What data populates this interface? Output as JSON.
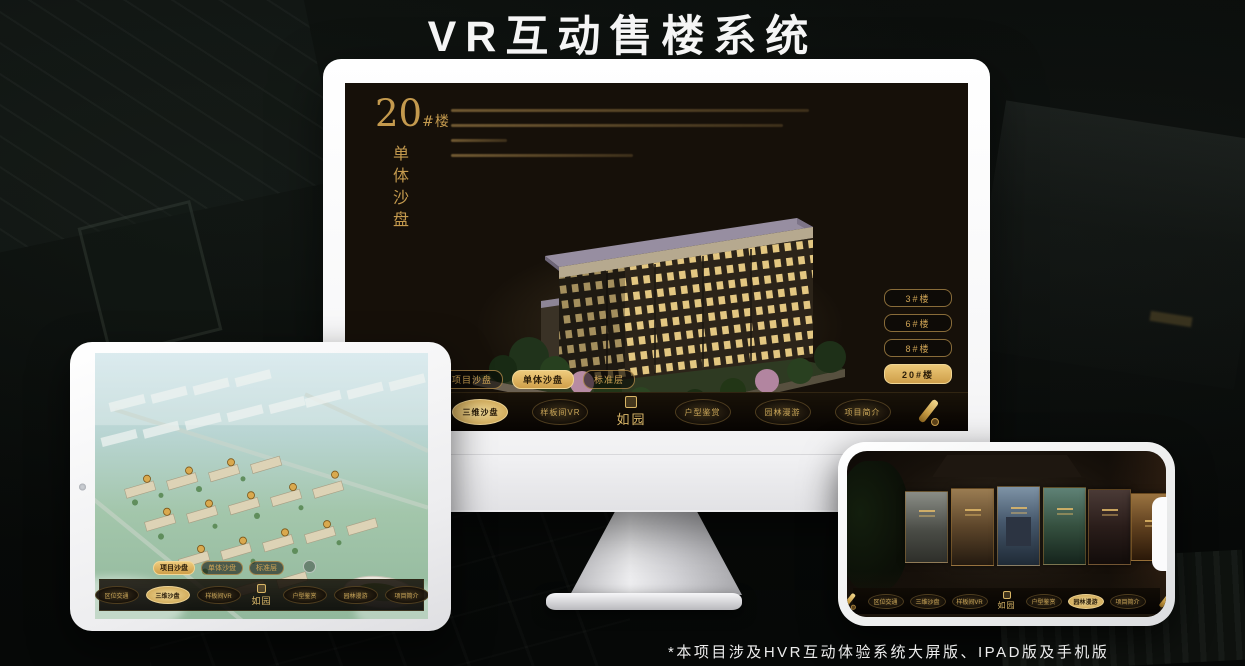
{
  "page": {
    "title": "VR互动售楼系统",
    "footnote": "*本项目涉及HVR互动体验系统大屏版、IPAD版及手机版"
  },
  "brand": {
    "logo": "如园",
    "accent_gold": "#C9A050",
    "screen_bg": "#161009"
  },
  "monitor": {
    "headline": {
      "number": "20",
      "suffix": "#楼",
      "subtitle": "单体沙盘"
    },
    "floor_buttons": [
      {
        "label": "3#楼",
        "active": false
      },
      {
        "label": "6#楼",
        "active": false
      },
      {
        "label": "8#楼",
        "active": false
      },
      {
        "label": "20#楼",
        "active": true
      }
    ],
    "mode_buttons": [
      {
        "label": "项目沙盘",
        "active": false
      },
      {
        "label": "单体沙盘",
        "active": true
      },
      {
        "label": "标准层",
        "active": false
      }
    ],
    "menu": {
      "logo": "如园",
      "left": [
        {
          "label": "区位交通",
          "active": false
        },
        {
          "label": "三维沙盘",
          "active": true
        },
        {
          "label": "样板间VR",
          "active": false
        }
      ],
      "right": [
        {
          "label": "户型鉴赏",
          "active": false
        },
        {
          "label": "园林漫游",
          "active": false
        },
        {
          "label": "项目简介",
          "active": false
        }
      ]
    }
  },
  "ipad": {
    "mode_buttons": [
      {
        "label": "项目沙盘",
        "active": true
      },
      {
        "label": "单体沙盘",
        "active": false
      },
      {
        "label": "标准层",
        "active": false
      }
    ],
    "menu": {
      "logo": "如园",
      "left": [
        {
          "label": "区位交通",
          "active": false
        },
        {
          "label": "三维沙盘",
          "active": true
        },
        {
          "label": "样板间VR",
          "active": false
        }
      ],
      "right": [
        {
          "label": "户型鉴赏",
          "active": false
        },
        {
          "label": "园林漫游",
          "active": false
        },
        {
          "label": "项目简介",
          "active": false
        }
      ]
    }
  },
  "phone": {
    "menu": {
      "logo": "如园",
      "left": [
        {
          "label": "区位交通",
          "active": false
        },
        {
          "label": "三维沙盘",
          "active": false
        },
        {
          "label": "样板间VR",
          "active": false
        }
      ],
      "right": [
        {
          "label": "户型鉴赏",
          "active": false
        },
        {
          "label": "园林漫游",
          "active": true
        },
        {
          "label": "项目简介",
          "active": false
        }
      ]
    }
  }
}
